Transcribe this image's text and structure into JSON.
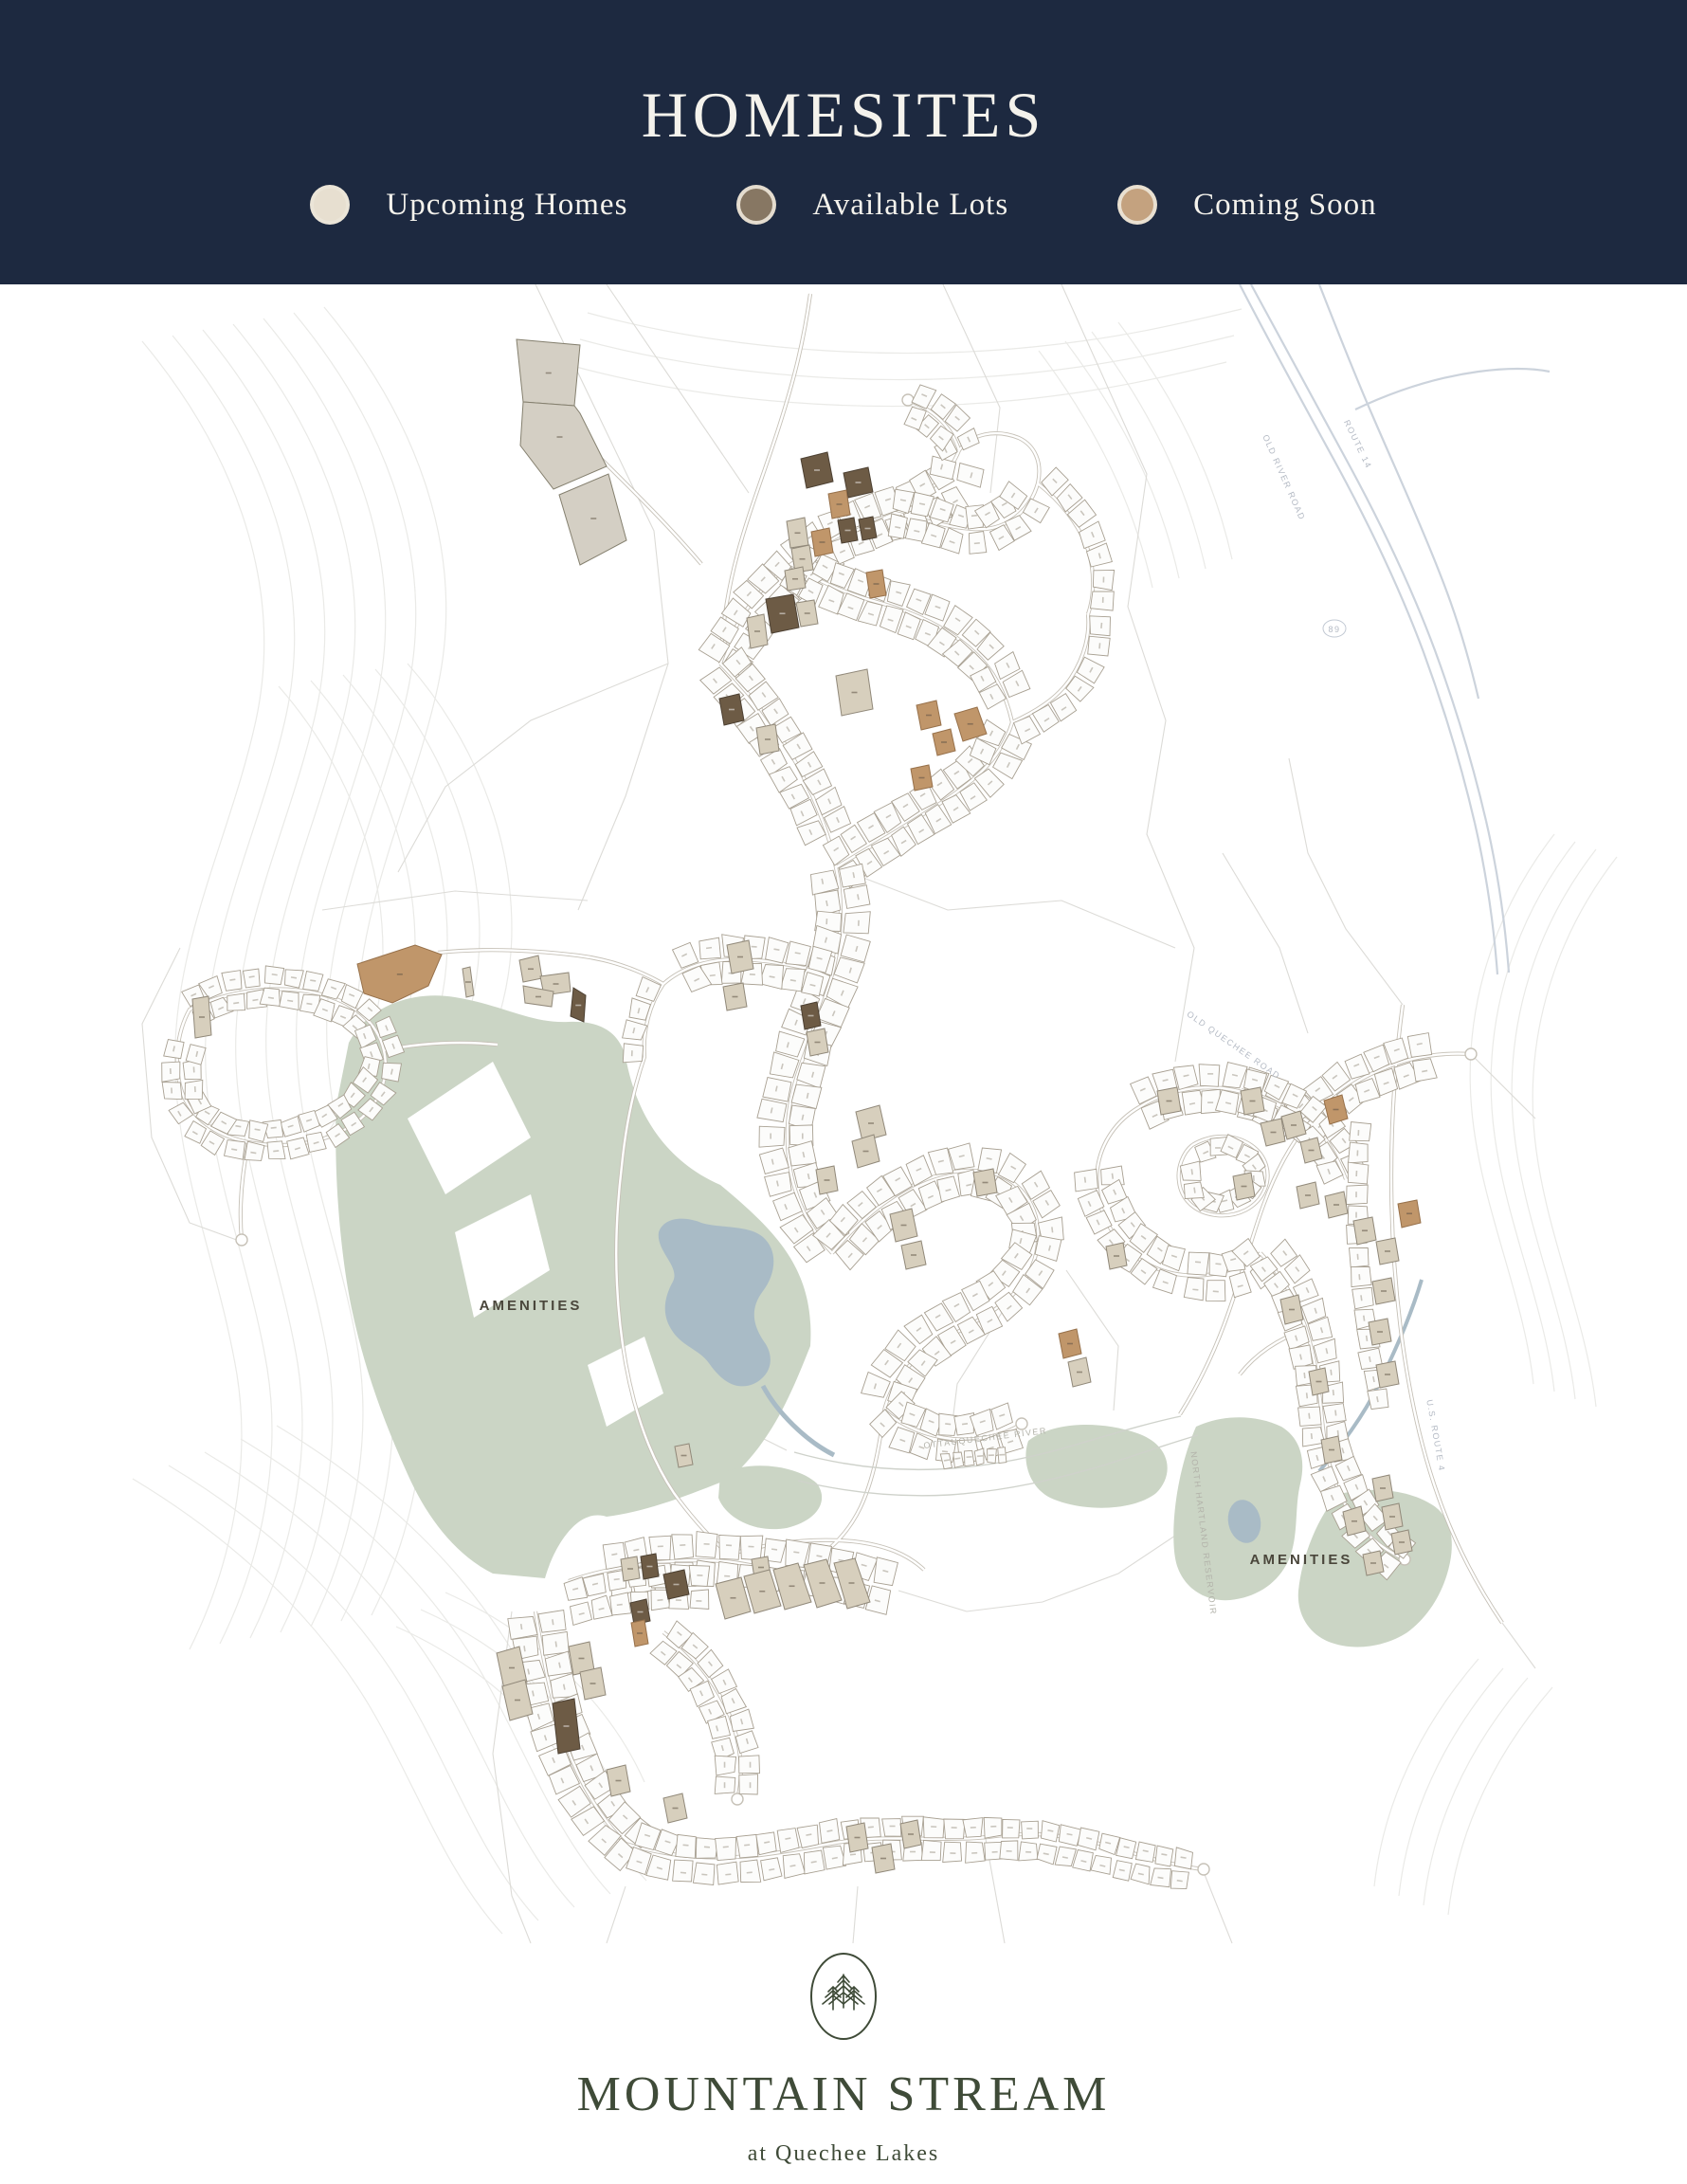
{
  "header": {
    "title": "HOMESITES",
    "legend": [
      {
        "label": "Upcoming Homes",
        "color": "#e7dfd0",
        "status_key": "upcoming"
      },
      {
        "label": "Available Lots",
        "color": "#877763",
        "status_key": "available"
      },
      {
        "label": "Coming Soon",
        "color": "#c4a27f",
        "status_key": "coming_soon"
      }
    ]
  },
  "map": {
    "labels": {
      "amenities_west": "AMENITIES",
      "amenities_east": "AMENITIES",
      "river": "OTTAUQUECHEE RIVER",
      "reservoir": "NORTH HARTLAND RESERVOIR",
      "route4": "U.S. ROUTE 4",
      "route14": "ROUTE 14",
      "old_river_road": "OLD RIVER ROAD",
      "old_quechee_road": "OLD QUECHEE ROAD",
      "interstate": "89"
    },
    "colors": {
      "navy": "#1d2940",
      "upcoming": "#d7cfbd",
      "available": "#6d5b45",
      "coming_soon": "#c0966a",
      "big_parcel": "#d4cfc4",
      "green": "#cbd5c5",
      "water": "#a9bbc6",
      "white_lot": "#fcfcfb",
      "lot_outline": "#a8a092"
    }
  },
  "footer": {
    "brand": "MOUNTAIN STREAM",
    "tagline": "at Quechee Lakes",
    "logo": "pine-trees-icon"
  }
}
